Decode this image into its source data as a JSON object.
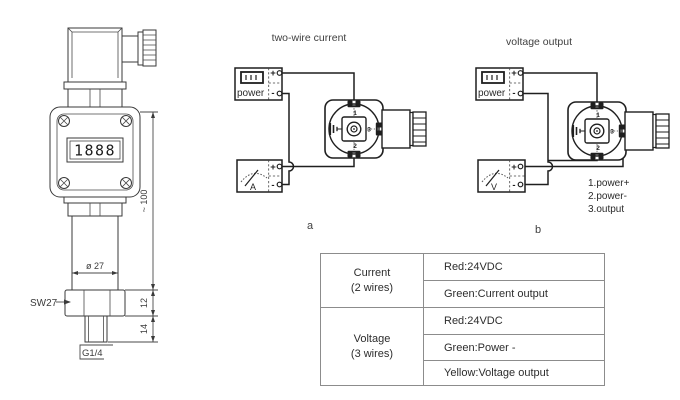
{
  "transmitter": {
    "display_value": "1888",
    "height_dim": "~ 100",
    "diameter_dim": "ø 27",
    "wrench_label": "SW27",
    "hex_height_dim": "12",
    "thread_height_dim": "14",
    "thread_label": "G1/4"
  },
  "connector_pins": {
    "pin1": "1",
    "pin2": "2",
    "pin3": "3"
  },
  "diagram_a": {
    "title": "two-wire current",
    "caption": "a",
    "power_label": "power",
    "meter_label": "A",
    "plus": "+",
    "minus": "-"
  },
  "diagram_b": {
    "title": "voltage output",
    "caption": "b",
    "power_label": "power",
    "meter_label": "V",
    "plus": "+",
    "minus": "-",
    "pin_legend": [
      "1.power+",
      "2.power-",
      "3.output"
    ]
  },
  "wiring_table": {
    "groups": [
      {
        "type": "Current",
        "wires_note": "(2 wires)",
        "rows": [
          "Red:24VDC",
          "Green:Current output"
        ]
      },
      {
        "type": "Voltage",
        "wires_note": "(3 wires)",
        "rows": [
          "Red:24VDC",
          "Green:Power -",
          "Yellow:Voltage output"
        ]
      }
    ]
  },
  "colors": {
    "drawing_line": "#3a3a3a",
    "wire_line": "#1f1f1f",
    "table_border": "#8c8c8c",
    "text": "#303030"
  }
}
